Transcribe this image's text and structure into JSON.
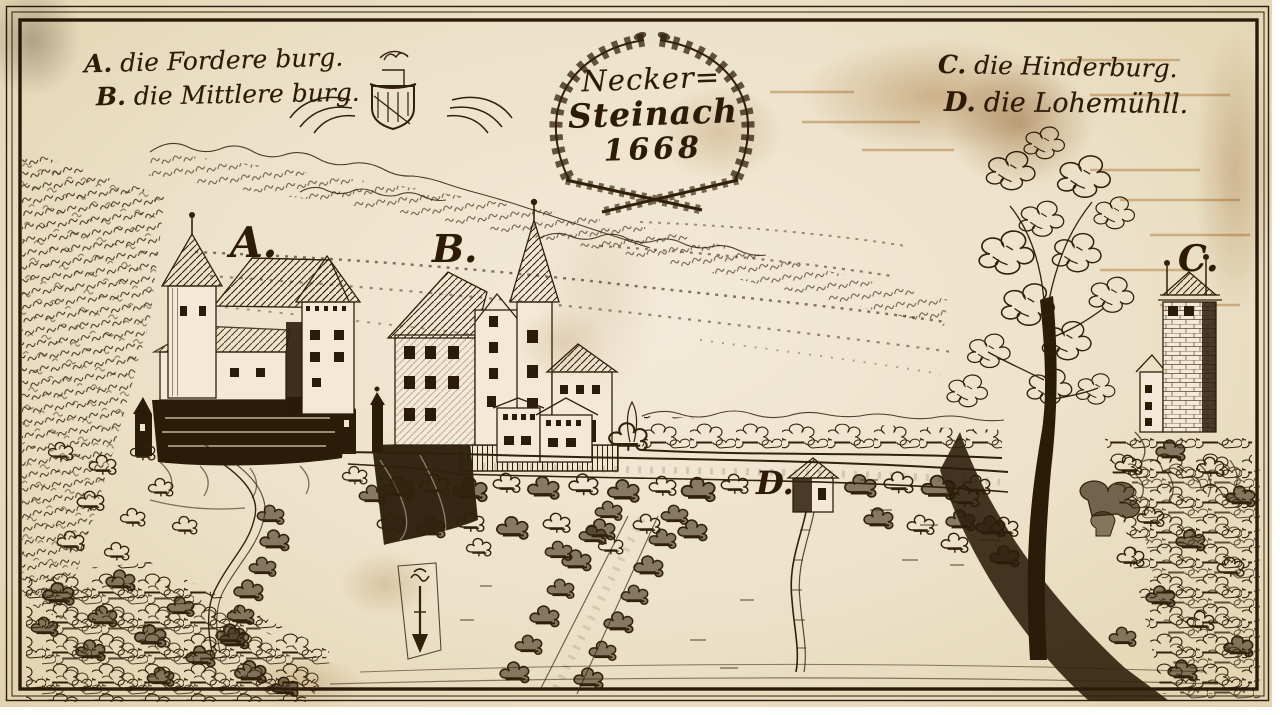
{
  "title": {
    "line1": "Necker=",
    "line2": "Steinach",
    "year": "1668"
  },
  "legend": {
    "top_left": [
      {
        "letter": "A.",
        "name": "die Fordere burg."
      },
      {
        "letter": "B.",
        "name": "die Mittlere burg."
      }
    ],
    "top_right": [
      {
        "letter": "C.",
        "name": "die Hinderburg."
      },
      {
        "letter": "D.",
        "name": "die Lohemühll."
      }
    ]
  },
  "markers": {
    "vorderburg": "A.",
    "mittelburg": "B.",
    "hinterburg": "C.",
    "mill": "D."
  },
  "colors": {
    "paper": "#ece1c8",
    "ink": "#31200c",
    "stain": "#b08447"
  }
}
